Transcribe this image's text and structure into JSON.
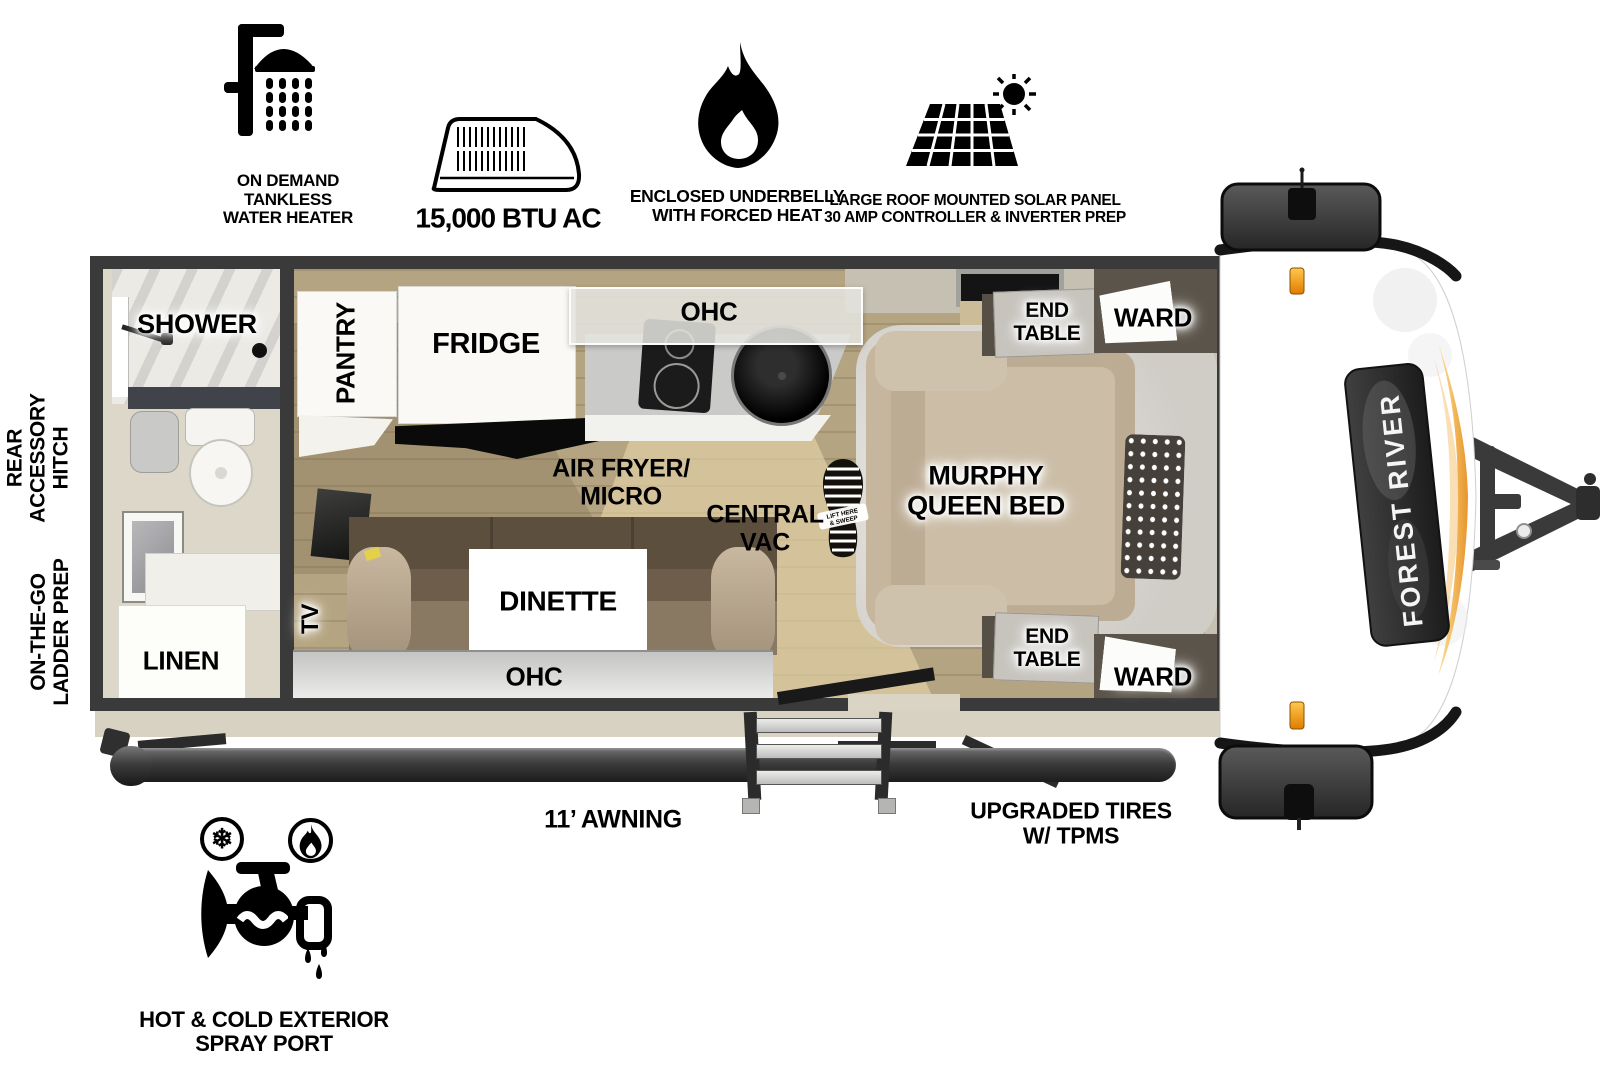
{
  "features_top": {
    "water_heater_label": "ON DEMAND\nTANKLESS\nWATER HEATER",
    "ac_label": "15,000 BTU AC",
    "underbelly_label": "ENCLOSED UNDERBELLY\nWITH FORCED HEAT",
    "solar_label": "LARGE ROOF MOUNTED SOLAR PANEL\n30 AMP CONTROLLER & INVERTER PREP"
  },
  "exterior": {
    "rear_hitch_label": "REAR\nACCESSORY\nHITCH",
    "ladder_prep_label": "ON-THE-GO\nLADDER PREP",
    "awning_label": "11’ AWNING",
    "tires_label": "UPGRADED TIRES\nW/ TPMS",
    "spray_port_label": "HOT & COLD EXTERIOR\nSPRAY PORT",
    "snowflake_glyph": "❄"
  },
  "floorplan": {
    "shower": "SHOWER",
    "linen": "LINEN",
    "pantry": "PANTRY",
    "fridge": "FRIDGE",
    "ohc_kitchen": "OHC",
    "air_fryer_micro": "AIR FRYER/\nMICRO",
    "central_vac": "CENTRAL\nVAC",
    "vac_sweep_line1": "LIFT HERE",
    "vac_sweep_line2": "& SWEEP",
    "murphy_bed": "MURPHY\nQUEEN BED",
    "end_table_top": "END\nTABLE",
    "ward_top": "WARD",
    "end_table_bottom": "END\nTABLE",
    "ward_bottom": "WARD",
    "tv": "TV",
    "dinette": "DINETTE",
    "ohc_dinette": "OHC"
  },
  "branding": {
    "make": "FOREST RIVER"
  },
  "icons": {
    "water_heater": "shower-icon",
    "ac": "ac-unit-icon",
    "underbelly": "flame-icon",
    "solar": "solar-panel-icon",
    "spray_cold": "snowflake-icon",
    "spray_hot": "hot-flame-icon",
    "spray_port": "spray-faucet-icon",
    "central_vac": "bootprint-icon"
  },
  "colors": {
    "wall": "#3a3a3a",
    "wood_floor": "#b5a481",
    "accent_orange": "#e8952a",
    "marker_amber": "#f5a623",
    "label_text": "#000000",
    "background": "#ffffff"
  }
}
